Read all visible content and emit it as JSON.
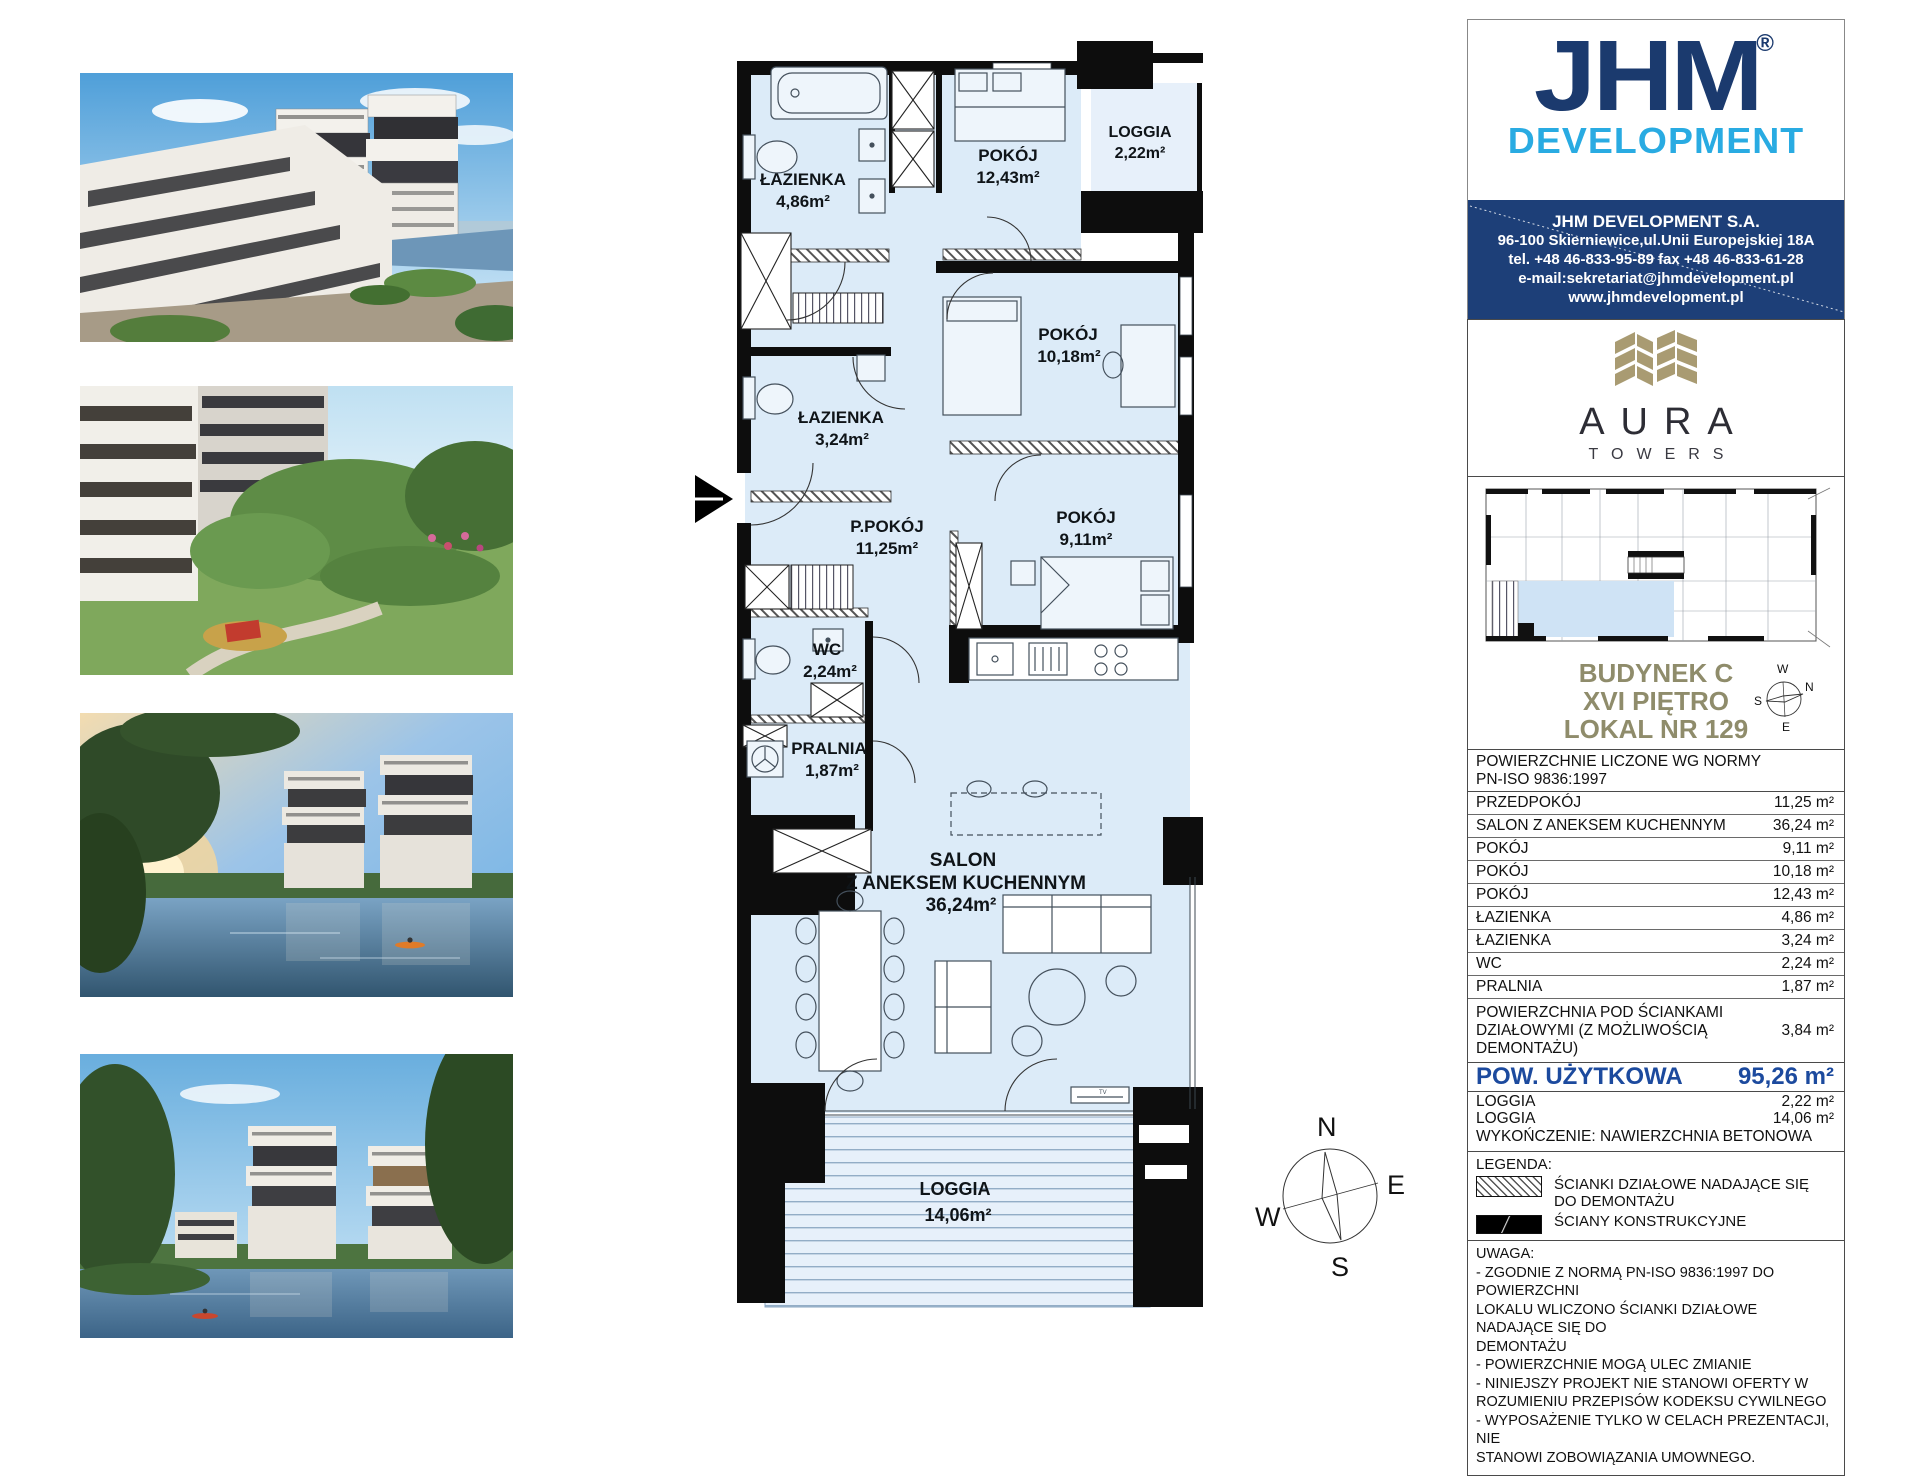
{
  "company": {
    "name_jhm": "JHM",
    "reg": "®",
    "name_dev": "DEVELOPMENT",
    "name": "JHM DEVELOPMENT S.A.",
    "addr": "96-100 Skierniewice,ul.Unii Europejskiej 18A",
    "tel_fax": "tel. +48 46-833-95-89   fax +48 46-833-61-28",
    "email": "e-mail:sekretariat@jhmdevelopment.pl",
    "www": "www.jhmdevelopment.pl"
  },
  "aura": {
    "name": "AURA",
    "sub": "TOWERS"
  },
  "unit": {
    "building": "BUDYNEK C",
    "floor": "XVI PIĘTRO",
    "number": "LOKAL NR 129"
  },
  "table": {
    "header": "POWIERZCHNIE LICZONE WG NORMY\nPN-ISO 9836:1997",
    "rows": [
      {
        "label": "PRZEDPOKÓJ",
        "value": "11,25 m²"
      },
      {
        "label": "SALON Z ANEKSEM KUCHENNYM",
        "value": "36,24 m²"
      },
      {
        "label": "POKÓJ",
        "value": "9,11 m²"
      },
      {
        "label": "POKÓJ",
        "value": "10,18 m²"
      },
      {
        "label": "POKÓJ",
        "value": "12,43 m²"
      },
      {
        "label": "ŁAZIENKA",
        "value": "4,86 m²"
      },
      {
        "label": "ŁAZIENKA",
        "value": "3,24 m²"
      },
      {
        "label": "WC",
        "value": "2,24 m²"
      },
      {
        "label": "PRALNIA",
        "value": "1,87 m²"
      },
      {
        "label": "POWIERZCHNIA POD ŚCIANKAMI\nDZIAŁOWYMI (Z MOŻLIWOŚCIĄ\nDEMONTAŻU)",
        "value": "3,84 m²"
      }
    ],
    "total_label": "POW. UŻYTKOWA",
    "total_value": "95,26 m²",
    "loggia1_label": "LOGGIA",
    "loggia1_value": "2,22 m²",
    "loggia2_label": "LOGGIA",
    "loggia2_value": "14,06 m²",
    "finish": "WYKOŃCZENIE: NAWIERZCHNIA BETONOWA"
  },
  "legend": {
    "title": "LEGENDA:",
    "partition": "ŚCIANKI DZIAŁOWE NADAJĄCE SIĘ\nDO DEMONTAŻU",
    "structural": "ŚCIANY KONSTRUKCYJNE"
  },
  "notes": {
    "title": "UWAGA:",
    "body": "- ZGODNIE Z NORMĄ PN-ISO 9836:1997 DO POWIERZCHNI\nLOKALU WLICZONO ŚCIANKI DZIAŁOWE NADAJĄCE SIĘ DO\nDEMONTAŻU\n- POWIERZCHNIE MOGĄ ULEC ZMIANIE\n- NINIEJSZY PROJEKT NIE STANOWI OFERTY W\nROZUMIENIU PRZEPISÓW KODEKSU CYWILNEGO\n- WYPOSAŻENIE TYLKO W CELACH PREZENTACJI, NIE\nSTANOWI ZOBOWIĄZANIA UMOWNEGO."
  },
  "plan": {
    "rooms": [
      {
        "name": "ŁAZIENKA",
        "area": "4,86m²"
      },
      {
        "name": "POKÓJ",
        "area": "12,43m²"
      },
      {
        "name": "LOGGIA",
        "area": "2,22m²"
      },
      {
        "name": "POKÓJ",
        "area": "10,18m²"
      },
      {
        "name": "ŁAZIENKA",
        "area": "3,24m²"
      },
      {
        "name": "P.POKÓJ",
        "area": "11,25m²"
      },
      {
        "name": "POKÓJ",
        "area": "9,11m²"
      },
      {
        "name": "WC",
        "area": "2,24m²"
      },
      {
        "name": "PRALNIA",
        "area": "1,87m²"
      },
      {
        "name": "SALON",
        "line2": "Z ANEKSEM KUCHENNYM",
        "area": "36,24m²"
      },
      {
        "name": "LOGGIA",
        "area": "14,06m²"
      }
    ],
    "tv": "TV",
    "compass": {
      "n": "N",
      "e": "E",
      "s": "S",
      "w": "W"
    }
  },
  "colors": {
    "navy": "#1b3a6e",
    "cyan": "#29abe2",
    "contact_bg": "#1d3f78",
    "aura_gold": "#a99b72",
    "unit_text": "#8f8c6b",
    "total_blue": "#1c4a9e",
    "room_fill": "#dcebf8",
    "wall_black": "#0d0d0d"
  }
}
